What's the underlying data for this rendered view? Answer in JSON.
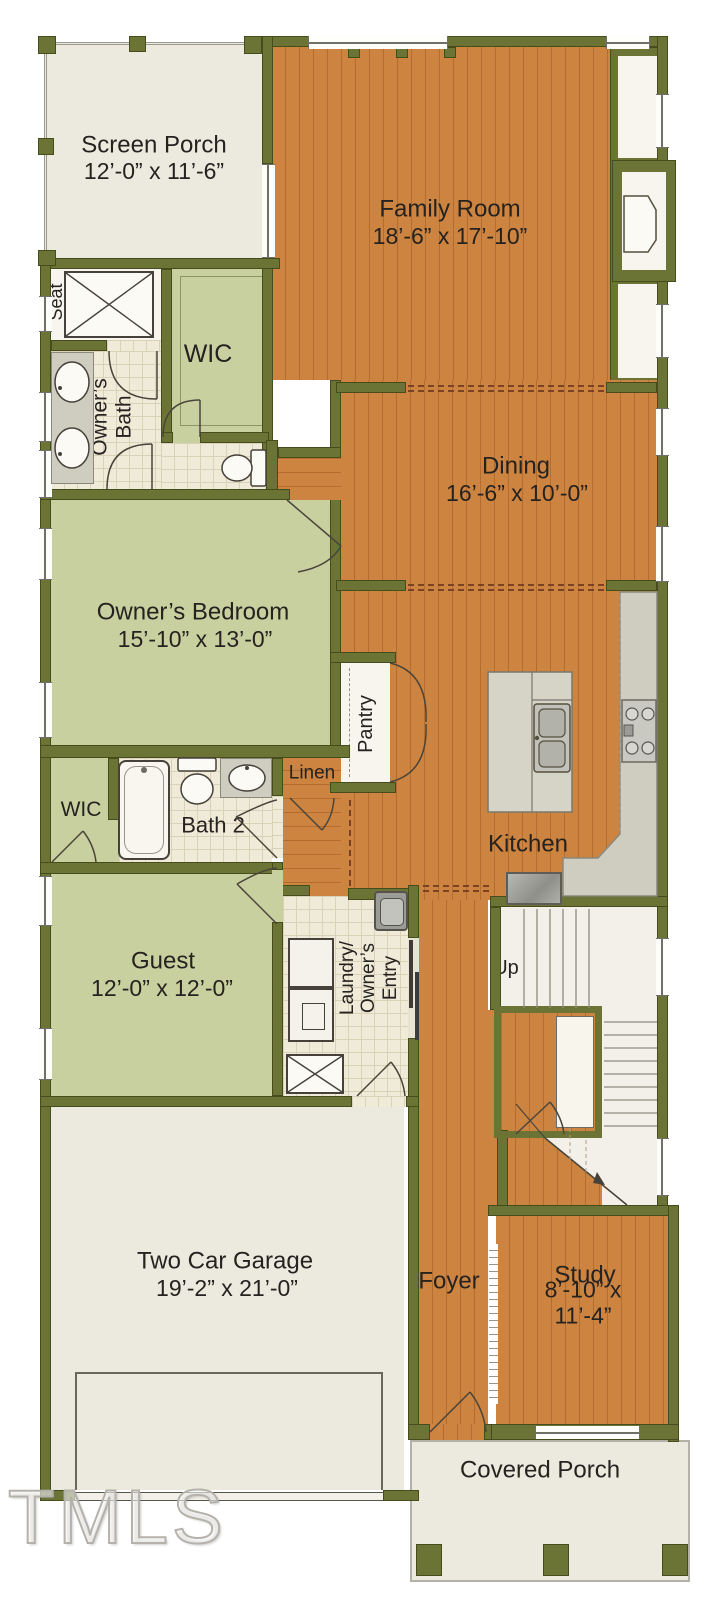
{
  "colors": {
    "wall_olive": "#6b7434",
    "wall_outline": "#454d1d",
    "wood_floor": "#cc8440",
    "wood_plank_line": "#b26d2f",
    "room_green": "#c8d0a0",
    "bath_tile": "#f0ead8",
    "porch_white": "#eceade",
    "counter_gray": "#cfccc0",
    "stair_white": "#f2f0e9",
    "label_text": "#262220",
    "opening_dash": "#6e3a20"
  },
  "rooms": {
    "screen_porch": {
      "name": "Screen Porch",
      "dims": "12’-0” x 11’-6”"
    },
    "family_room": {
      "name": "Family Room",
      "dims": "18’-6” x 17’-10”"
    },
    "opt_builtins_top": {
      "name": "Opt\nBuilt-Ins"
    },
    "opt_builtins_bottom": {
      "name": "Opt\nBuilt-Ins"
    },
    "seat": {
      "name": "Seat"
    },
    "wic_top": {
      "name": "WIC"
    },
    "owners_bath": {
      "name": "Owner’s\nBath"
    },
    "dining": {
      "name": "Dining",
      "dims": "16’-6” x 10’-0”"
    },
    "owners_bedroom": {
      "name": "Owner’s Bedroom",
      "dims": "15’-10” x 13’-0”"
    },
    "pantry": {
      "name": "Pantry"
    },
    "linen": {
      "name": "Linen"
    },
    "bath_2": {
      "name": "Bath 2"
    },
    "wic_2": {
      "name": "WIC"
    },
    "kitchen": {
      "name": "Kitchen"
    },
    "guest": {
      "name": "Guest",
      "dims": "12’-0” x 12’-0”"
    },
    "laundry": {
      "name": "Laundry/\nOwner’s\nEntry"
    },
    "stairs": {
      "up_label": "Up"
    },
    "opt_lockers": {
      "name": "Opt Lockers"
    },
    "two_car_garage": {
      "name": "Two Car Garage",
      "dims": "19’-2” x 21’-0”"
    },
    "foyer": {
      "name": "Foyer"
    },
    "study": {
      "name": "Study",
      "dims": "8’-10” x 11’-4”"
    },
    "covered_porch": {
      "name": "Covered Porch"
    }
  },
  "watermark": "TMLS"
}
